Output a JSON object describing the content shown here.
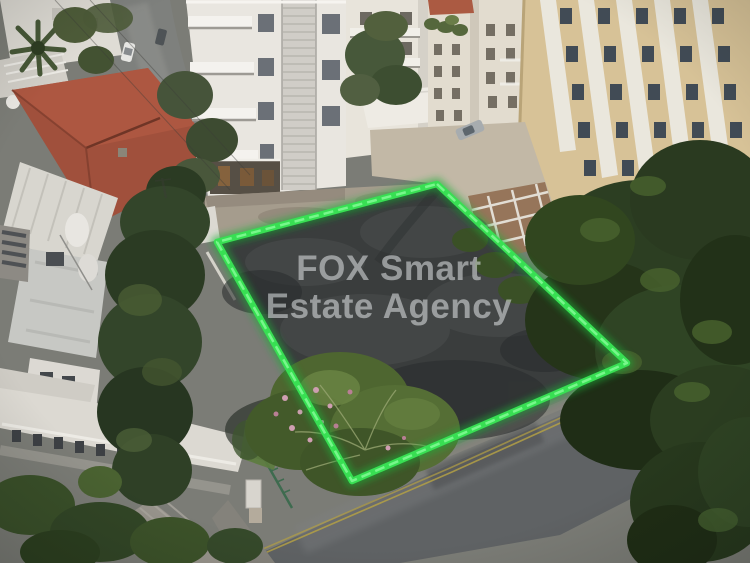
{
  "watermark": {
    "line1": "FOX Smart",
    "line2": "Estate Agency",
    "color_hex": "#aeb3b5"
  },
  "plot_outline": {
    "color_hex": "#38df53",
    "glow_hex": "#1faf39",
    "shape": "quadrilateral"
  },
  "scene": {
    "type": "aerial-drone-photo",
    "subject": "vacant-corner-plot-outlined-in-green",
    "elements": [
      "vacant-plot",
      "green-plot-outline",
      "agency-watermark",
      "white-apartment-buildings",
      "beige-apartment-building",
      "red-tile-roof-house",
      "rooftop-water-tanks",
      "cypress-trees",
      "pine-trees",
      "flowering-bush",
      "streets",
      "parked-cars",
      "school-building"
    ]
  }
}
